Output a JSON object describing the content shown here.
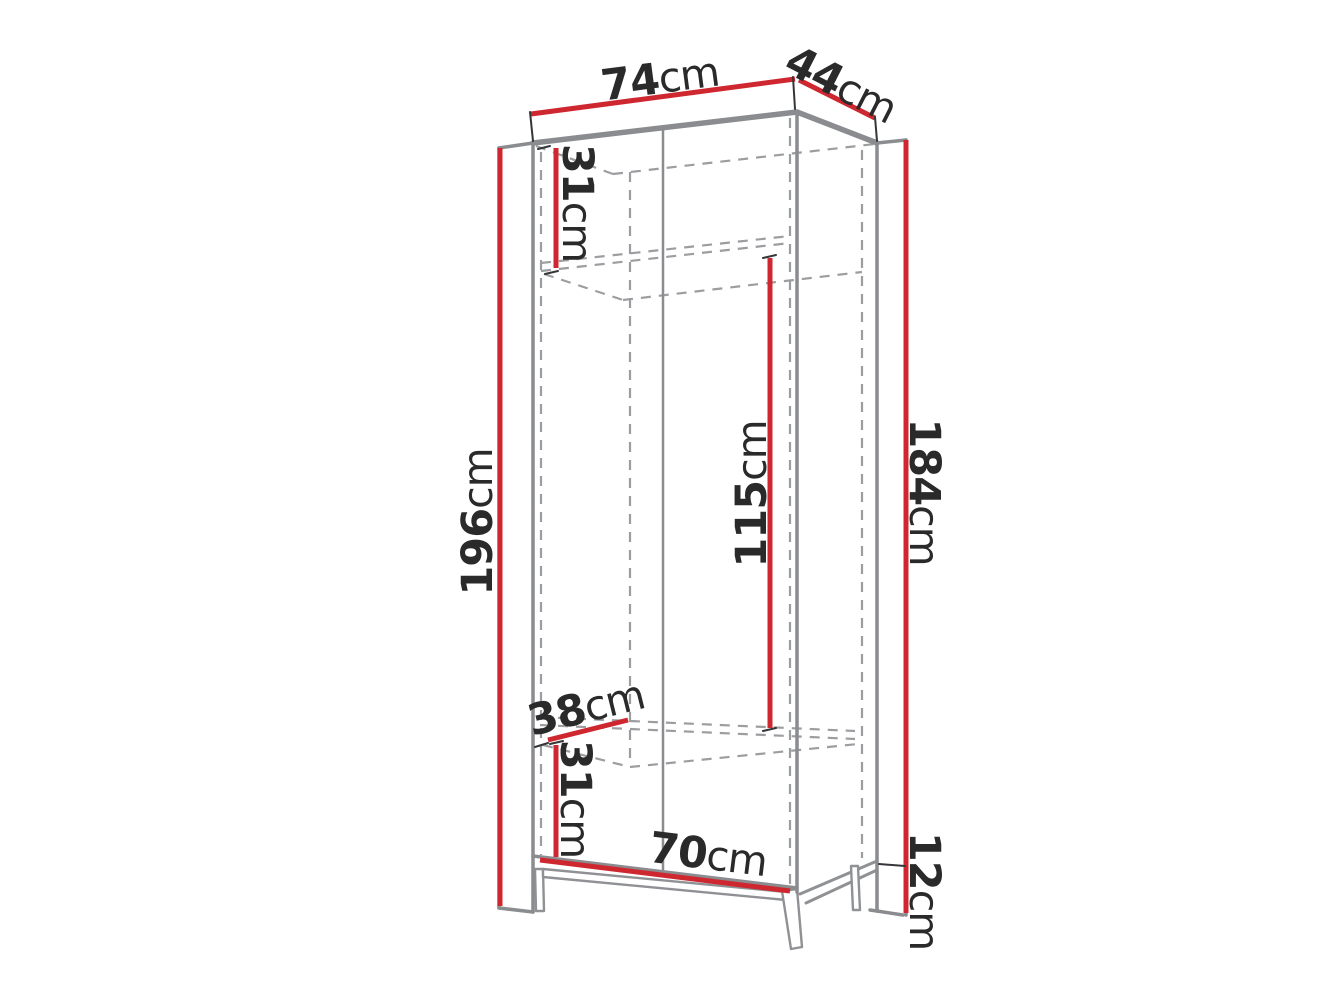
{
  "diagram": {
    "type": "furniture-dimension-diagram",
    "subject": "two-door wardrobe on metal legs, perspective line drawing"
  },
  "colors": {
    "red": "#cf2730",
    "gray": "#8a8c8f",
    "gray-dash": "#9b9da0",
    "gray-leg": "#8f9194",
    "ink": "#2b2a2a",
    "tick": "#35363a",
    "bg": "#ffffff"
  },
  "labels": [
    {
      "name": "top-width",
      "value": "74",
      "unit": "cm"
    },
    {
      "name": "top-depth",
      "value": "44",
      "unit": "cm"
    },
    {
      "name": "upper-section-height",
      "value": "31",
      "unit": "cm"
    },
    {
      "name": "overall-height",
      "value": "196",
      "unit": "cm"
    },
    {
      "name": "hanging-space-height",
      "value": "115",
      "unit": "cm"
    },
    {
      "name": "carcass-height",
      "value": "184",
      "unit": "cm"
    },
    {
      "name": "shelf-depth",
      "value": "38",
      "unit": "cm"
    },
    {
      "name": "lower-section-height",
      "value": "31",
      "unit": "cm"
    },
    {
      "name": "interior-width",
      "value": "70",
      "unit": "cm"
    },
    {
      "name": "leg-height",
      "value": "12",
      "unit": "cm"
    }
  ]
}
